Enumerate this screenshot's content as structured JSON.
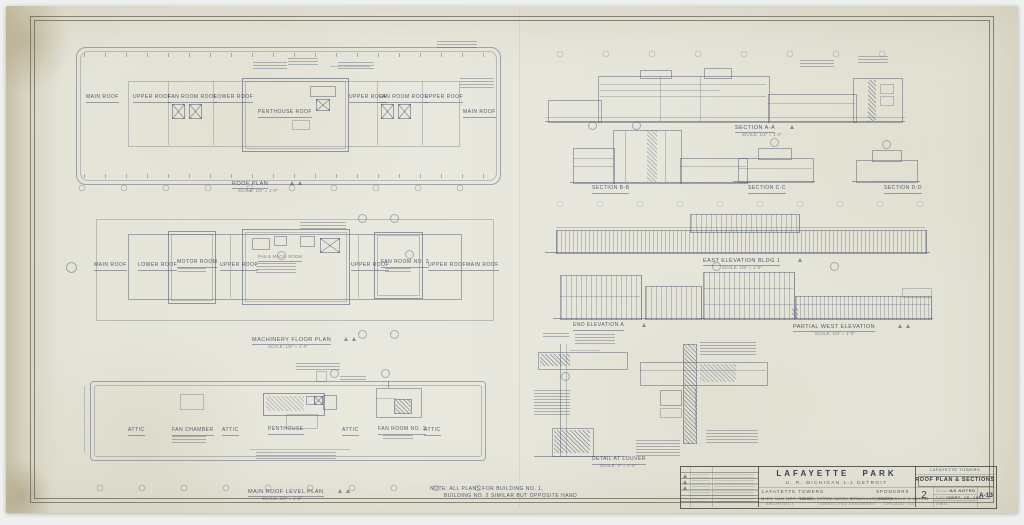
{
  "plans": {
    "roof": {
      "title": "ROOF PLAN",
      "scale": "SCALE: 1/8\" = 1'-0\"",
      "rooms": [
        "MAIN ROOF",
        "UPPER ROOF",
        "FAN ROOM ROOF",
        "LOWER ROOF",
        "PENTHOUSE ROOF",
        "UPPER ROOF",
        "FAN ROOM ROOF",
        "UPPER ROOF",
        "MAIN ROOF"
      ]
    },
    "machinery": {
      "title": "MACHINERY FLOOR PLAN",
      "scale": "SCALE: 1/8\" = 1'-0\"",
      "center_room": "FAN & MACH. ROOM",
      "rooms": [
        "MAIN ROOF",
        "LOWER ROOF",
        "MOTOR ROOM",
        "UPPER ROOF",
        "UPPER ROOF",
        "FAN ROOM NO. 2",
        "UPPER ROOF",
        "MAIN ROOF"
      ]
    },
    "main_roof": {
      "title": "MAIN ROOF LEVEL PLAN",
      "scale": "SCALE: 1/8\" = 1'-0\"",
      "rooms": [
        "ATTIC",
        "FAN CHAMBER",
        "ATTIC",
        "PENTHOUSE",
        "ATTIC",
        "FAN ROOM NO. 2",
        "ATTIC"
      ]
    }
  },
  "sections": {
    "a": {
      "label": "SECTION A-A",
      "scale": "SCALE: 1/4\" = 1'-0\""
    },
    "b": {
      "label": "SECTION B-B"
    },
    "c": {
      "label": "SECTION C-C"
    },
    "d": {
      "label": "SECTION D-D"
    }
  },
  "elevations": {
    "east": {
      "label": "EAST ELEVATION BLDG 1",
      "scale": "SCALE: 1/8\" = 1'-0\""
    },
    "end": {
      "label": "END ELEVATION A"
    },
    "west": {
      "label": "PARTIAL WEST ELEVATION",
      "scale": "SCALE: 1/8\" = 1'-0\""
    }
  },
  "details": {
    "louver": {
      "label": "DETAIL AT LOUVER",
      "scale": "SCALE: 3\" = 1'-0\""
    }
  },
  "note": {
    "line1": "NOTE:  ALL PLANS FOR BUILDING NO. 1,",
    "line2": "BUILDING NO. 2 SIMILAR BUT OPPOSITE HAND"
  },
  "titleblock": {
    "project": "LAFAYETTE PARK",
    "subtitle": "U. R.  MICHIGAN  1-1  DETROIT",
    "building": "LAFAYETTE  TOWERS",
    "sponsors": "SPONSORS",
    "firm1_name": "MIES VAN DER ROHE",
    "firm1_role": "ARCHITECT",
    "firm2_name": "NELSON, OSTROM, BASKIN, BERMAN & ASSOCIATES",
    "firm2_role": "CONSULTING ENGINEERS",
    "firm3_name": "GREENWALD & KATZIN",
    "firm3_role": "CHICAGO, ILL.",
    "series": "LAFAYETTE  TOWERS",
    "sheet_title": "ROOF PLAN & SECTIONS",
    "building_no": "2",
    "scale_label": "SCALE",
    "scale_value": "AS NOTED",
    "date_label": "DATE",
    "date_value": "SEPT. 15, 1961",
    "drawn_label": "DWG.",
    "sheet_no": "A-13"
  }
}
